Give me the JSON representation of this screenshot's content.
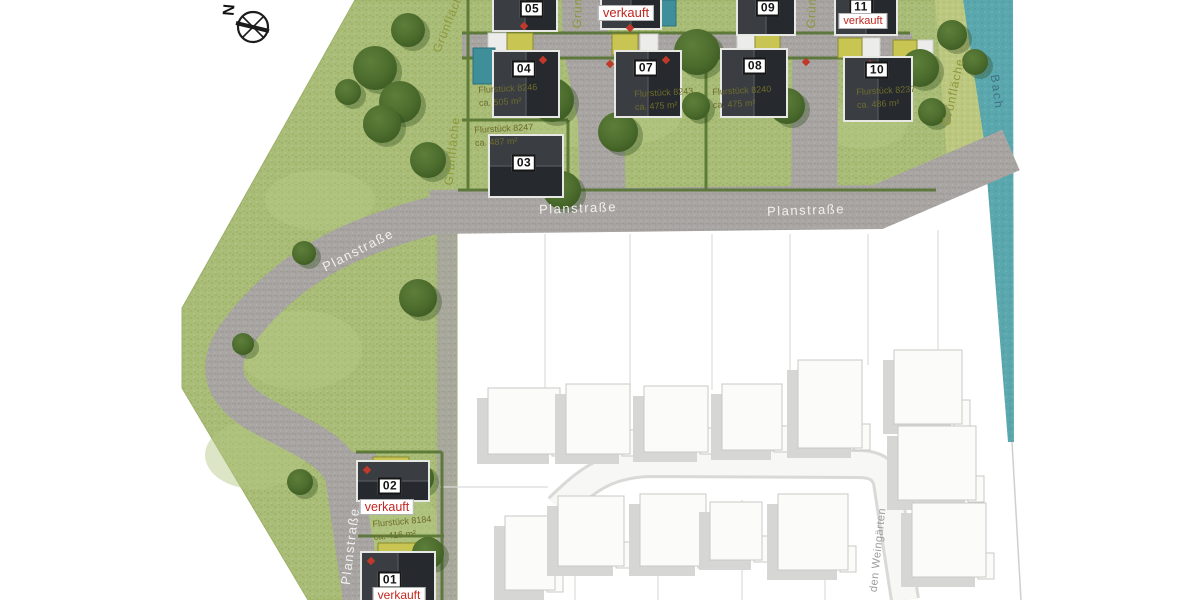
{
  "compass": {
    "north": "N"
  },
  "labels": {
    "street": "Planstraße",
    "green": "Grünfläche",
    "stream": "Bach",
    "existing_street": "den Weingärten",
    "sold": "verkauft"
  },
  "houses": [
    {
      "num": "01",
      "sold": true
    },
    {
      "num": "02",
      "sold": true,
      "parcel": "Flurstück 8184",
      "area": "ca. 416 m²"
    },
    {
      "num": "03",
      "parcel": "Flurstück 8247",
      "area": "ca. 487 m²"
    },
    {
      "num": "04",
      "parcel": "Flurstück 8246",
      "area": "ca. 505 m²"
    },
    {
      "num": "05"
    },
    {
      "sold": true
    },
    {
      "num": "07",
      "parcel": "Flurstück 8243",
      "area": "ca. 475 m²"
    },
    {
      "num": "08",
      "parcel": "Flurstück 8240",
      "area": "ca. 475 m²"
    },
    {
      "num": "09"
    },
    {
      "num": "10",
      "parcel": "Flurstück 8237",
      "area": "ca. 486 m²"
    },
    {
      "num": "11",
      "sold": true
    }
  ],
  "colors": {
    "sold_red": "#c22620",
    "lawn": "#a9bd78",
    "water": "#5aa7ae",
    "roof": "#2b2e32",
    "road": "#a8a5a2"
  }
}
